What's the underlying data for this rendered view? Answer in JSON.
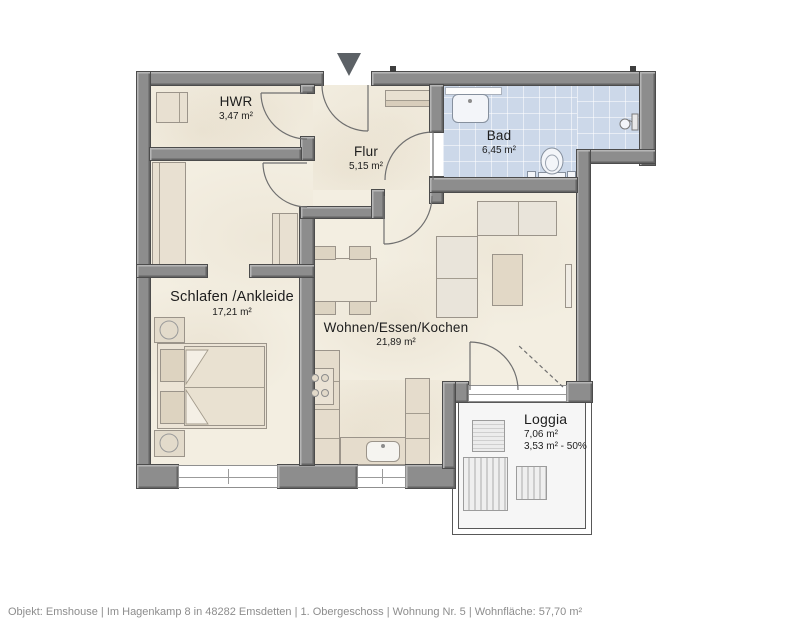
{
  "footer": "Objekt: Emshouse | Im Hagenkamp 8 in 48282 Emsdetten | 1. Obergeschoss | Wohnung Nr. 5 | Wohnfläche: 57,70 m²",
  "rooms": {
    "hwr": {
      "name": "HWR",
      "area": "3,47 m²"
    },
    "flur": {
      "name": "Flur",
      "area": "5,15 m²"
    },
    "bad": {
      "name": "Bad",
      "area": "6,45 m²"
    },
    "schlafen": {
      "name": "Schlafen /Ankleide",
      "area": "17,21 m²"
    },
    "wohnen": {
      "name": "Wohnen/Essen/Kochen",
      "area": "21,89 m²"
    },
    "loggia": {
      "name": "Loggia",
      "area": "7,06 m²",
      "area_weighted": "3,53 m² - 50%"
    }
  },
  "colors": {
    "wall": "#8d8d8d",
    "floor": "#f3eee1",
    "bath_floor": "#ccd8e9",
    "loggia_floor": "#f6f6f6",
    "entrance_arrow": "#5c6166"
  },
  "icons": {
    "entrance_arrow": "triangle-down"
  }
}
